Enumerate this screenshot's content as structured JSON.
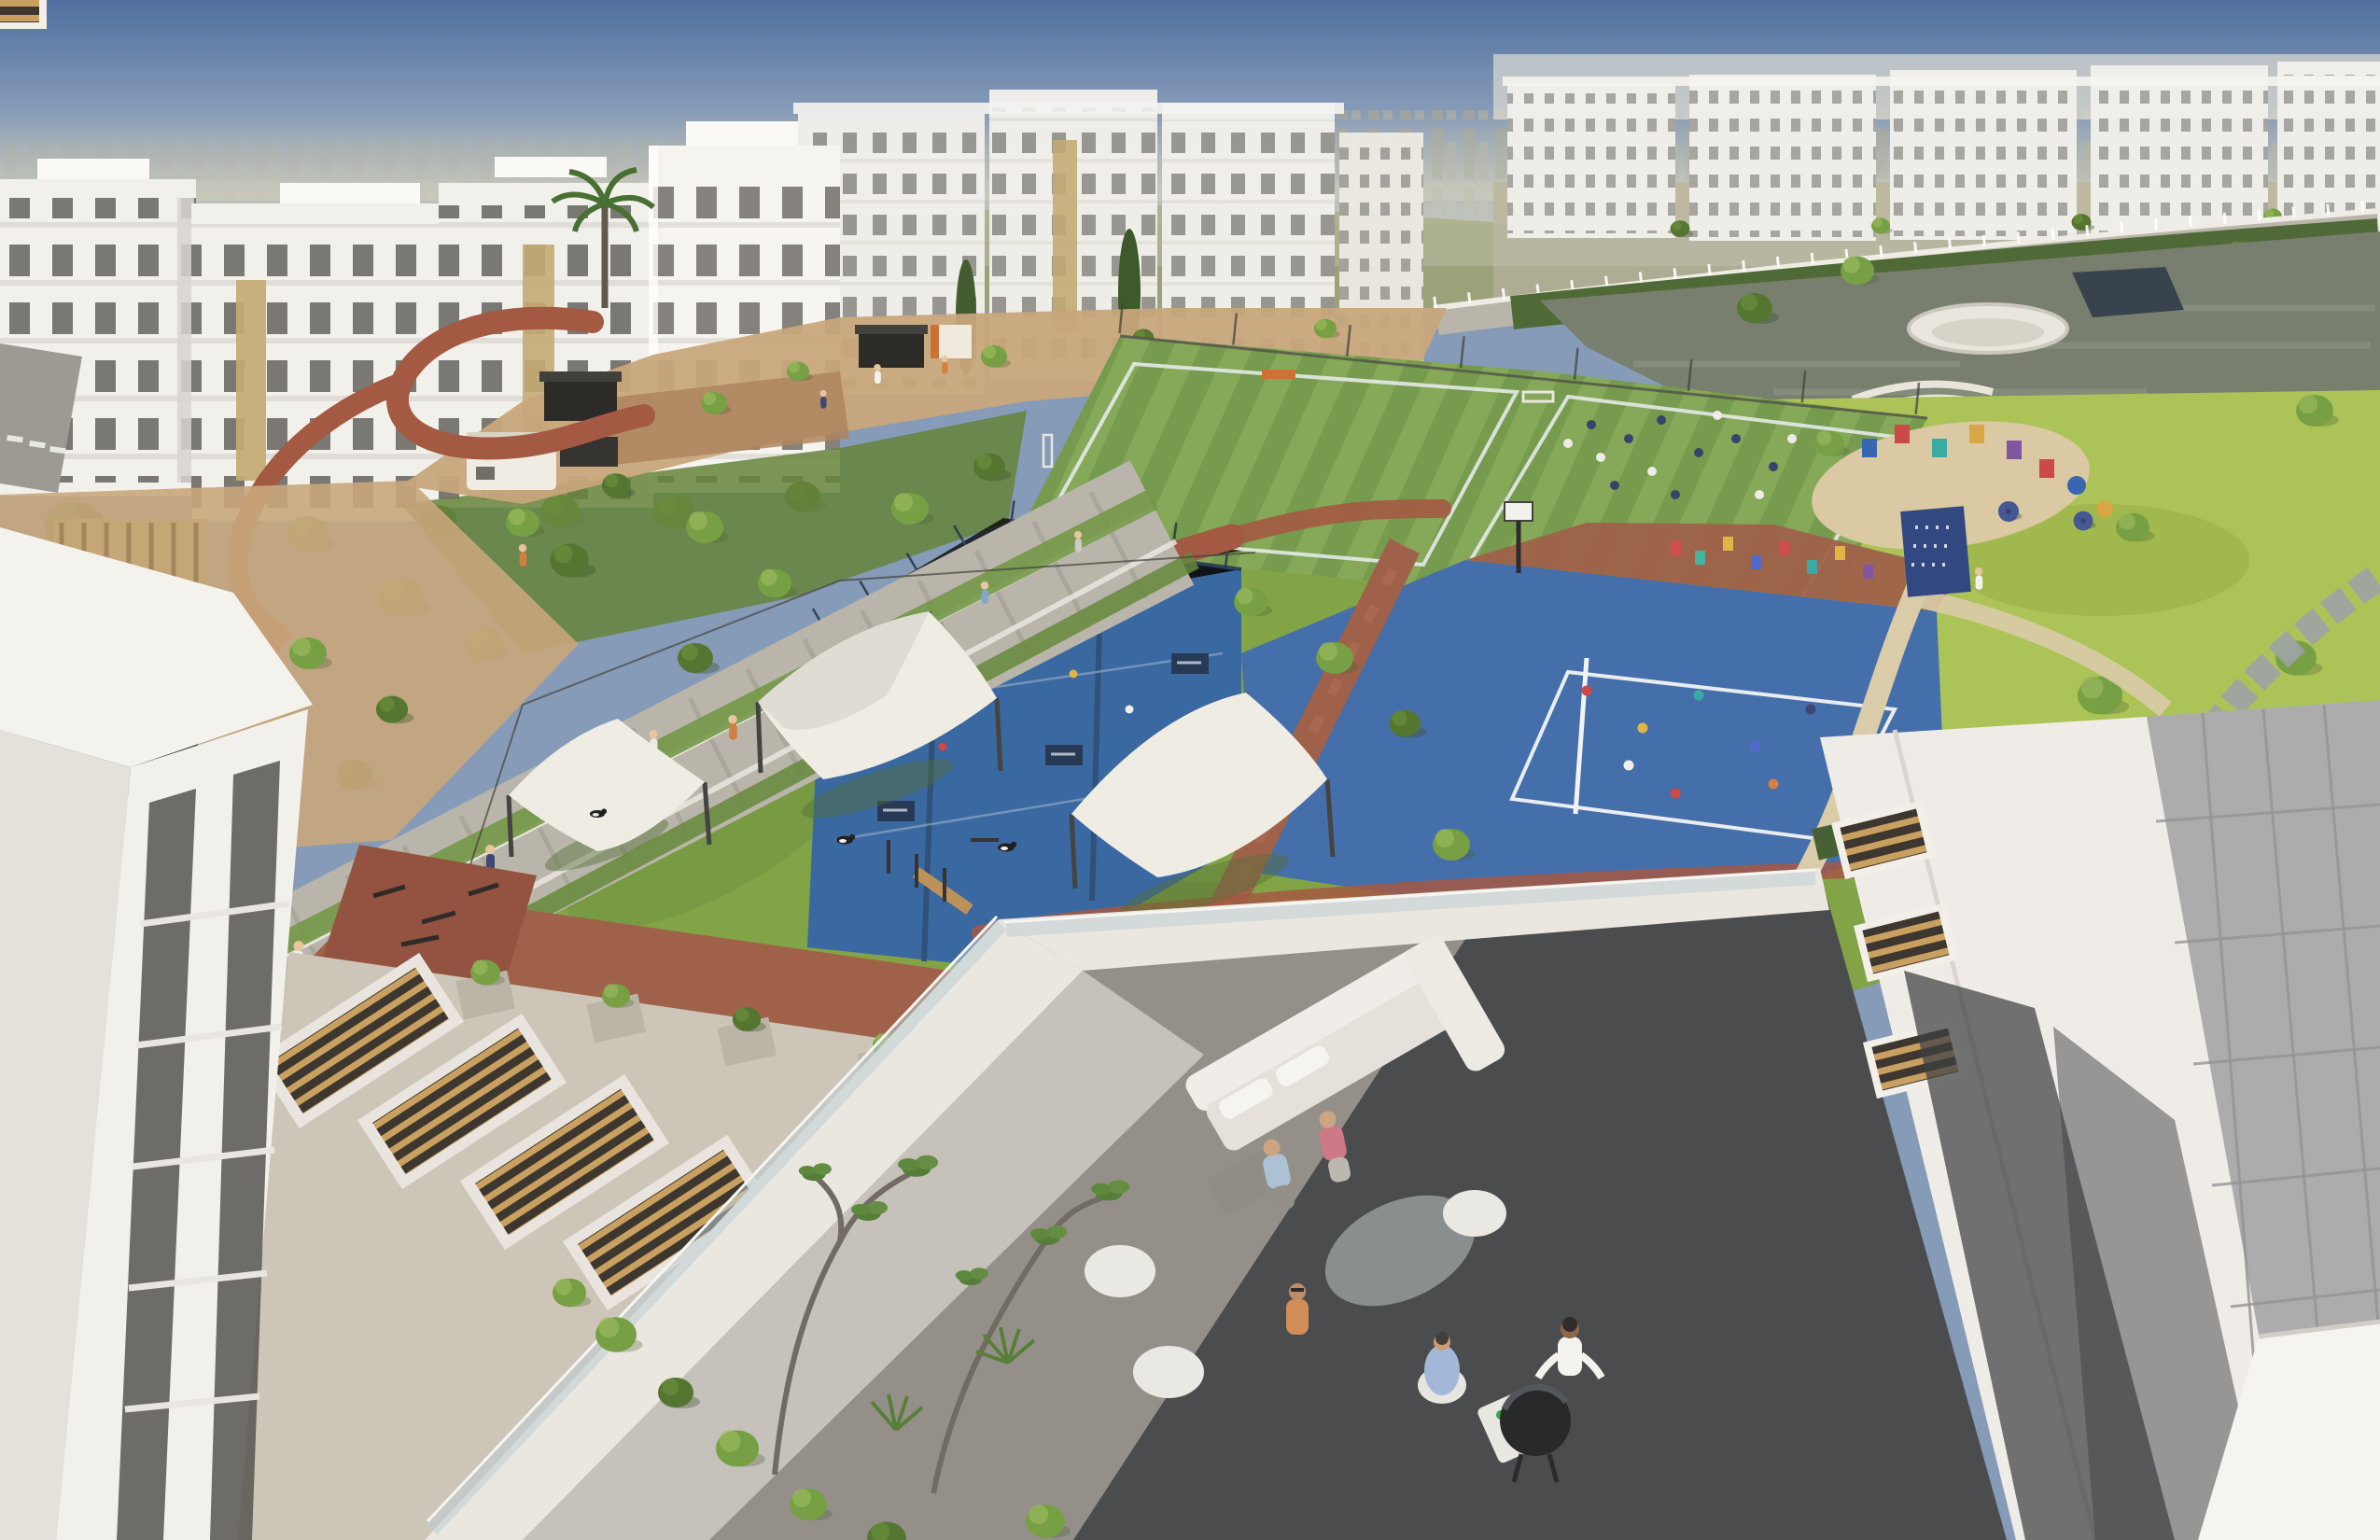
{
  "scene": {
    "type": "architectural-aerial-rendering",
    "regions": [
      "sky",
      "distant-city-skyline",
      "desert-hills",
      "apartment-buildings-top-left",
      "apartment-buildings-top-middle",
      "apartment-buildings-top-right",
      "curved-boulevard-with-white-fence",
      "lake",
      "sports-complex",
      "football-fields",
      "padel-courts",
      "multi-sport-court",
      "basketball-hoop",
      "running-track",
      "pedestrian-promenade",
      "kiosks",
      "dog-park-shade-sails",
      "community-park-lawn",
      "playground",
      "picnic-umbrellas",
      "podium-roof-skylights",
      "outdoor-gym",
      "plaza",
      "foreground-rooftop-terrace",
      "terrace-sofa",
      "terrace-dining",
      "bbq-grill",
      "foreground-building-left",
      "foreground-building-right",
      "louvered-skylights",
      "tiled-roof"
    ]
  },
  "palette": {
    "sky_top": "#46699c",
    "sky_mid": "#8097b6",
    "sky_haze": "#bcbfb4",
    "distant_city": "#a2a496",
    "hills": "#98a06e",
    "hills_tan": "#b2ab88",
    "building_white": "#f2f1ed",
    "building_shade": "#d7d4cf",
    "window_dark": "#54534e",
    "accent_tan": "#c2a76f",
    "grass": "#7ca03f",
    "grass_light": "#a8c251",
    "grass_dark": "#5e7e33",
    "tree_green": "#6f9c3c",
    "tree_light": "#93b755",
    "tree_dark": "#4c7029",
    "turf": "#6f9747",
    "turf_stripe": "#7fa652",
    "court_blue": "#3c69a8",
    "padel_blue": "#30619f",
    "court_line": "#e9eef2",
    "track_red": "#a0523c",
    "brick_red": "#9a5a42",
    "gym_red": "#8f4a38",
    "paver": "#b6b3a8",
    "sand": "#c5a377",
    "path_cream": "#d8cba6",
    "stone_gray": "#98a0a3",
    "water": "#717a6a",
    "roof_concrete": "#cbc4b7",
    "roof_gray": "#a9a9ab",
    "roof_white": "#efede8",
    "shadow": "#35373c",
    "sail": "#eeece4",
    "wood": "#c79c5a",
    "glass": "#b9c9d1",
    "umbrella": "#3d5190"
  }
}
